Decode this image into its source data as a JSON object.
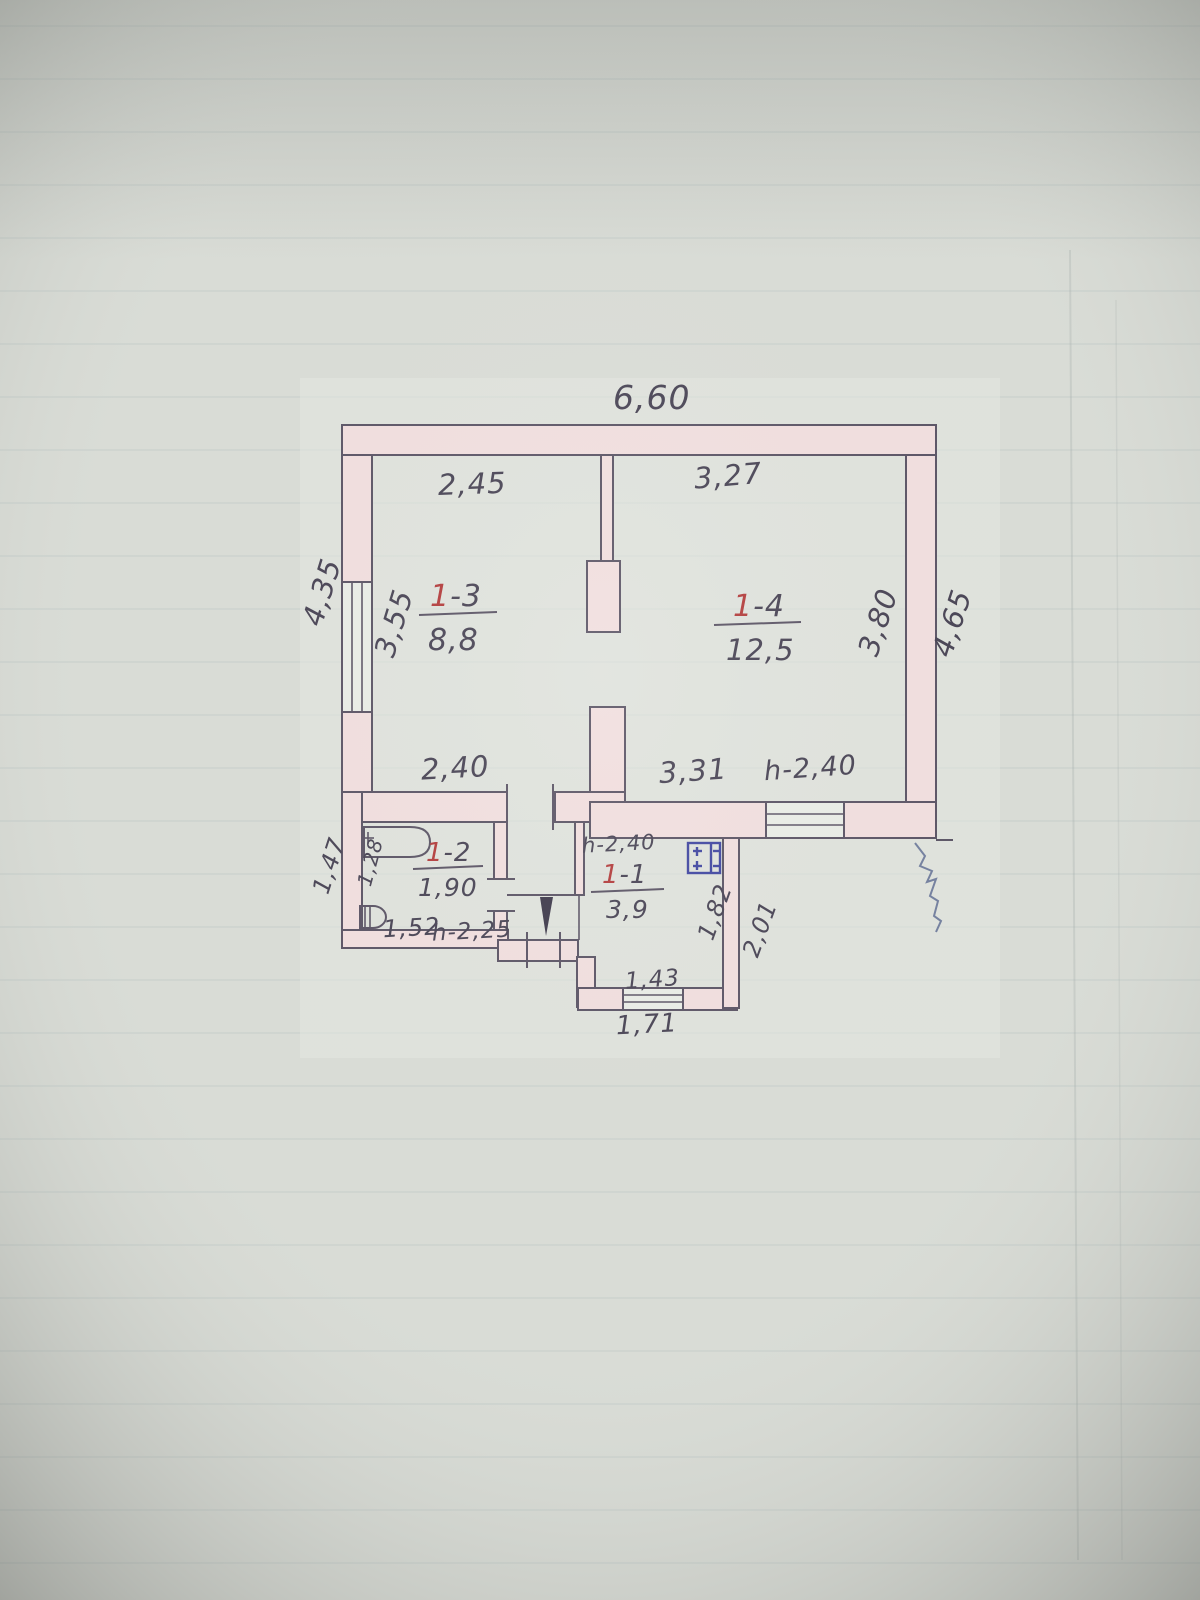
{
  "document": {
    "kind": "hand-drawn floor plan photograph",
    "palette": {
      "paper": "#d9dcd6",
      "plan_paper": "#e4e7e1",
      "wall_fill": "#f1dede",
      "ink": "#5a5364",
      "text": "#474253",
      "red_accent": "#b23a3a",
      "blue_ink": "#3f45a0"
    }
  },
  "plan": {
    "overall_width": "6,60",
    "left_outer_height": "4,35",
    "left_inner_height": "3,55",
    "right_inner_height": "3,80",
    "right_outer_height": "4,65"
  },
  "rooms": {
    "r11": {
      "num": "1",
      "dash": "-1",
      "area": "3,9",
      "ceiling_height": "h-2,40",
      "right_inner": "1,82",
      "right_outer": "2,01",
      "entry_width": "1,43",
      "entry_outer_width": "1,71"
    },
    "r12": {
      "num": "1",
      "dash": "-2",
      "area": "1,90",
      "left_width": "1,28",
      "bottom_width": "1,52",
      "ceiling_height": "h-2,25",
      "outer_left_height": "1,47"
    },
    "r13": {
      "num": "1",
      "dash": "-3",
      "area": "8,8",
      "top_width": "2,45",
      "bottom_width": "2,40"
    },
    "r14": {
      "num": "1",
      "dash": "-4",
      "area": "12,5",
      "top_width": "3,27",
      "bottom_width": "3,31",
      "window_height": "h-2,40"
    }
  }
}
